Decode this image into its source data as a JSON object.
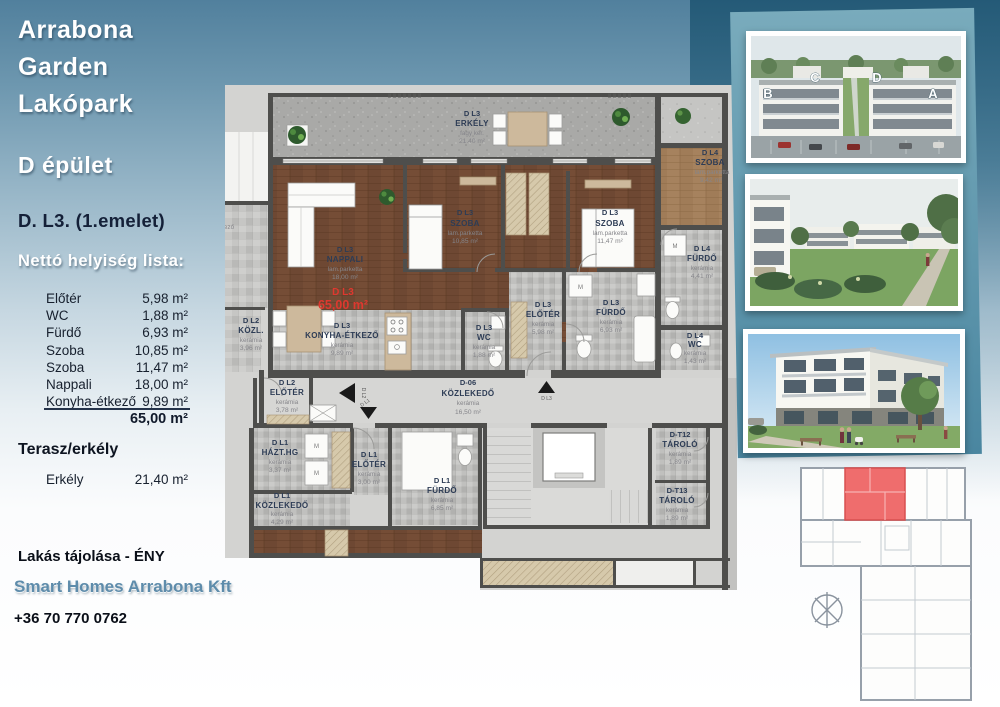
{
  "sidebar": {
    "project_title_lines": [
      "Arrabona",
      "Garden",
      "Lakópark"
    ],
    "building": "D épület",
    "unit": "D. L3. (1.emelet)",
    "list_title": "Nettó helyiség lista:",
    "rooms": [
      {
        "name": "Előtér",
        "area": "5,98 m²"
      },
      {
        "name": "WC",
        "area": "1,88 m²"
      },
      {
        "name": "Fürdő",
        "area": "6,93 m²"
      },
      {
        "name": "Szoba",
        "area": "10,85 m²"
      },
      {
        "name": "Szoba",
        "area": "11,47 m²"
      },
      {
        "name": "Nappali",
        "area": "18,00 m²"
      },
      {
        "name": "Konyha-étkező",
        "area": "9,89 m²"
      }
    ],
    "total_area": "65,00 m²",
    "terrace_title": "Terasz/erkély",
    "terrace_row": {
      "name": "Erkély",
      "area": "21,40 m²"
    },
    "orientation": "Lakás tájolása - ÉNY",
    "company": "Smart Homes Arrabona Kft",
    "phone": "+36 70 770 0762"
  },
  "floorplan": {
    "labels": {
      "erkely": {
        "code": "D L3",
        "name": "ERKÉLY",
        "mat": "fagy ker.",
        "area": "21.40 m²"
      },
      "nappali": {
        "code": "D L3",
        "name": "NAPPALI",
        "mat": "lam.parketta",
        "area": "18,00 m²"
      },
      "szoba1": {
        "code": "D L3",
        "name": "SZOBA",
        "mat": "lam.parketta",
        "area": "10,85 m²"
      },
      "szoba2": {
        "code": "D L3",
        "name": "SZOBA",
        "mat": "lam.parketta",
        "area": "11,47 m²"
      },
      "konyha": {
        "code": "D L3",
        "name": "KONYHA-ÉTKEZŐ",
        "mat": "kerámia",
        "area": "9,89 m²"
      },
      "wc": {
        "code": "D L3",
        "name": "WC",
        "mat": "kerámia",
        "area": "1,88 m²"
      },
      "eloter": {
        "code": "D L3",
        "name": "ELŐTÉR",
        "mat": "kerámia",
        "area": "5,98 m²"
      },
      "furdo": {
        "code": "D L3",
        "name": "FÜRDŐ",
        "mat": "kerámia",
        "area": "6,93 m²"
      },
      "l4szoba": {
        "code": "D L4",
        "name": "SZOBA",
        "mat": "lam.parketta",
        "area": "9,42 m²"
      },
      "l4furdo": {
        "code": "D L4",
        "name": "FÜRDŐ",
        "mat": "kerámia",
        "area": "4,41 m²"
      },
      "l4wc": {
        "code": "D L4",
        "name": "WC",
        "mat": "kerámia",
        "area": "1,43 m²"
      },
      "l2kozl": {
        "code": "D L2",
        "name": "KÖZL.",
        "mat": "kerámia",
        "area": "3,96 m²"
      },
      "l2eloter": {
        "code": "D L2",
        "name": "ELŐTÉR",
        "mat": "kerámia",
        "area": "3,78 m²"
      },
      "d06": {
        "code": "D-06",
        "name": "KÖZLEKEDŐ",
        "mat": "kerámia",
        "area": "16,50 m²"
      },
      "l1hazthg": {
        "code": "D L1",
        "name": "HÁZT.HG",
        "mat": "kerámia",
        "area": "3,37 m²"
      },
      "l1eloter": {
        "code": "D L1",
        "name": "ELŐTÉR",
        "mat": "kerámia",
        "area": "3,00 m²"
      },
      "l1kozl": {
        "code": "D L1",
        "name": "KÖZLEKEDŐ",
        "mat": "kerámia",
        "area": "4,29 m²"
      },
      "l1furdo": {
        "code": "D L1",
        "name": "FÜRDŐ",
        "mat": "kerámia",
        "area": "6,85 m²"
      },
      "t12": {
        "code": "D-T12",
        "name": "TÁROLÓ",
        "mat": "kerámia",
        "area": "1,89 m²"
      },
      "t13": {
        "code": "D-T13",
        "name": "TÁROLÓ",
        "mat": "kerámia",
        "area": "1,89 m²"
      }
    },
    "red_highlight": {
      "code": "D L3",
      "area": "65,00 m²"
    },
    "arrows": {
      "up": "D L3",
      "left": "D L2",
      "down": "D L1"
    },
    "washer": "M",
    "partial_label": "ező"
  },
  "photos": {
    "aerial": {
      "letters": [
        "B",
        "C",
        "D",
        "A"
      ]
    }
  },
  "accent_colors": {
    "red_unit": "#ef6d6d",
    "teal": "#4a86a0",
    "navy_text": "#142038"
  }
}
